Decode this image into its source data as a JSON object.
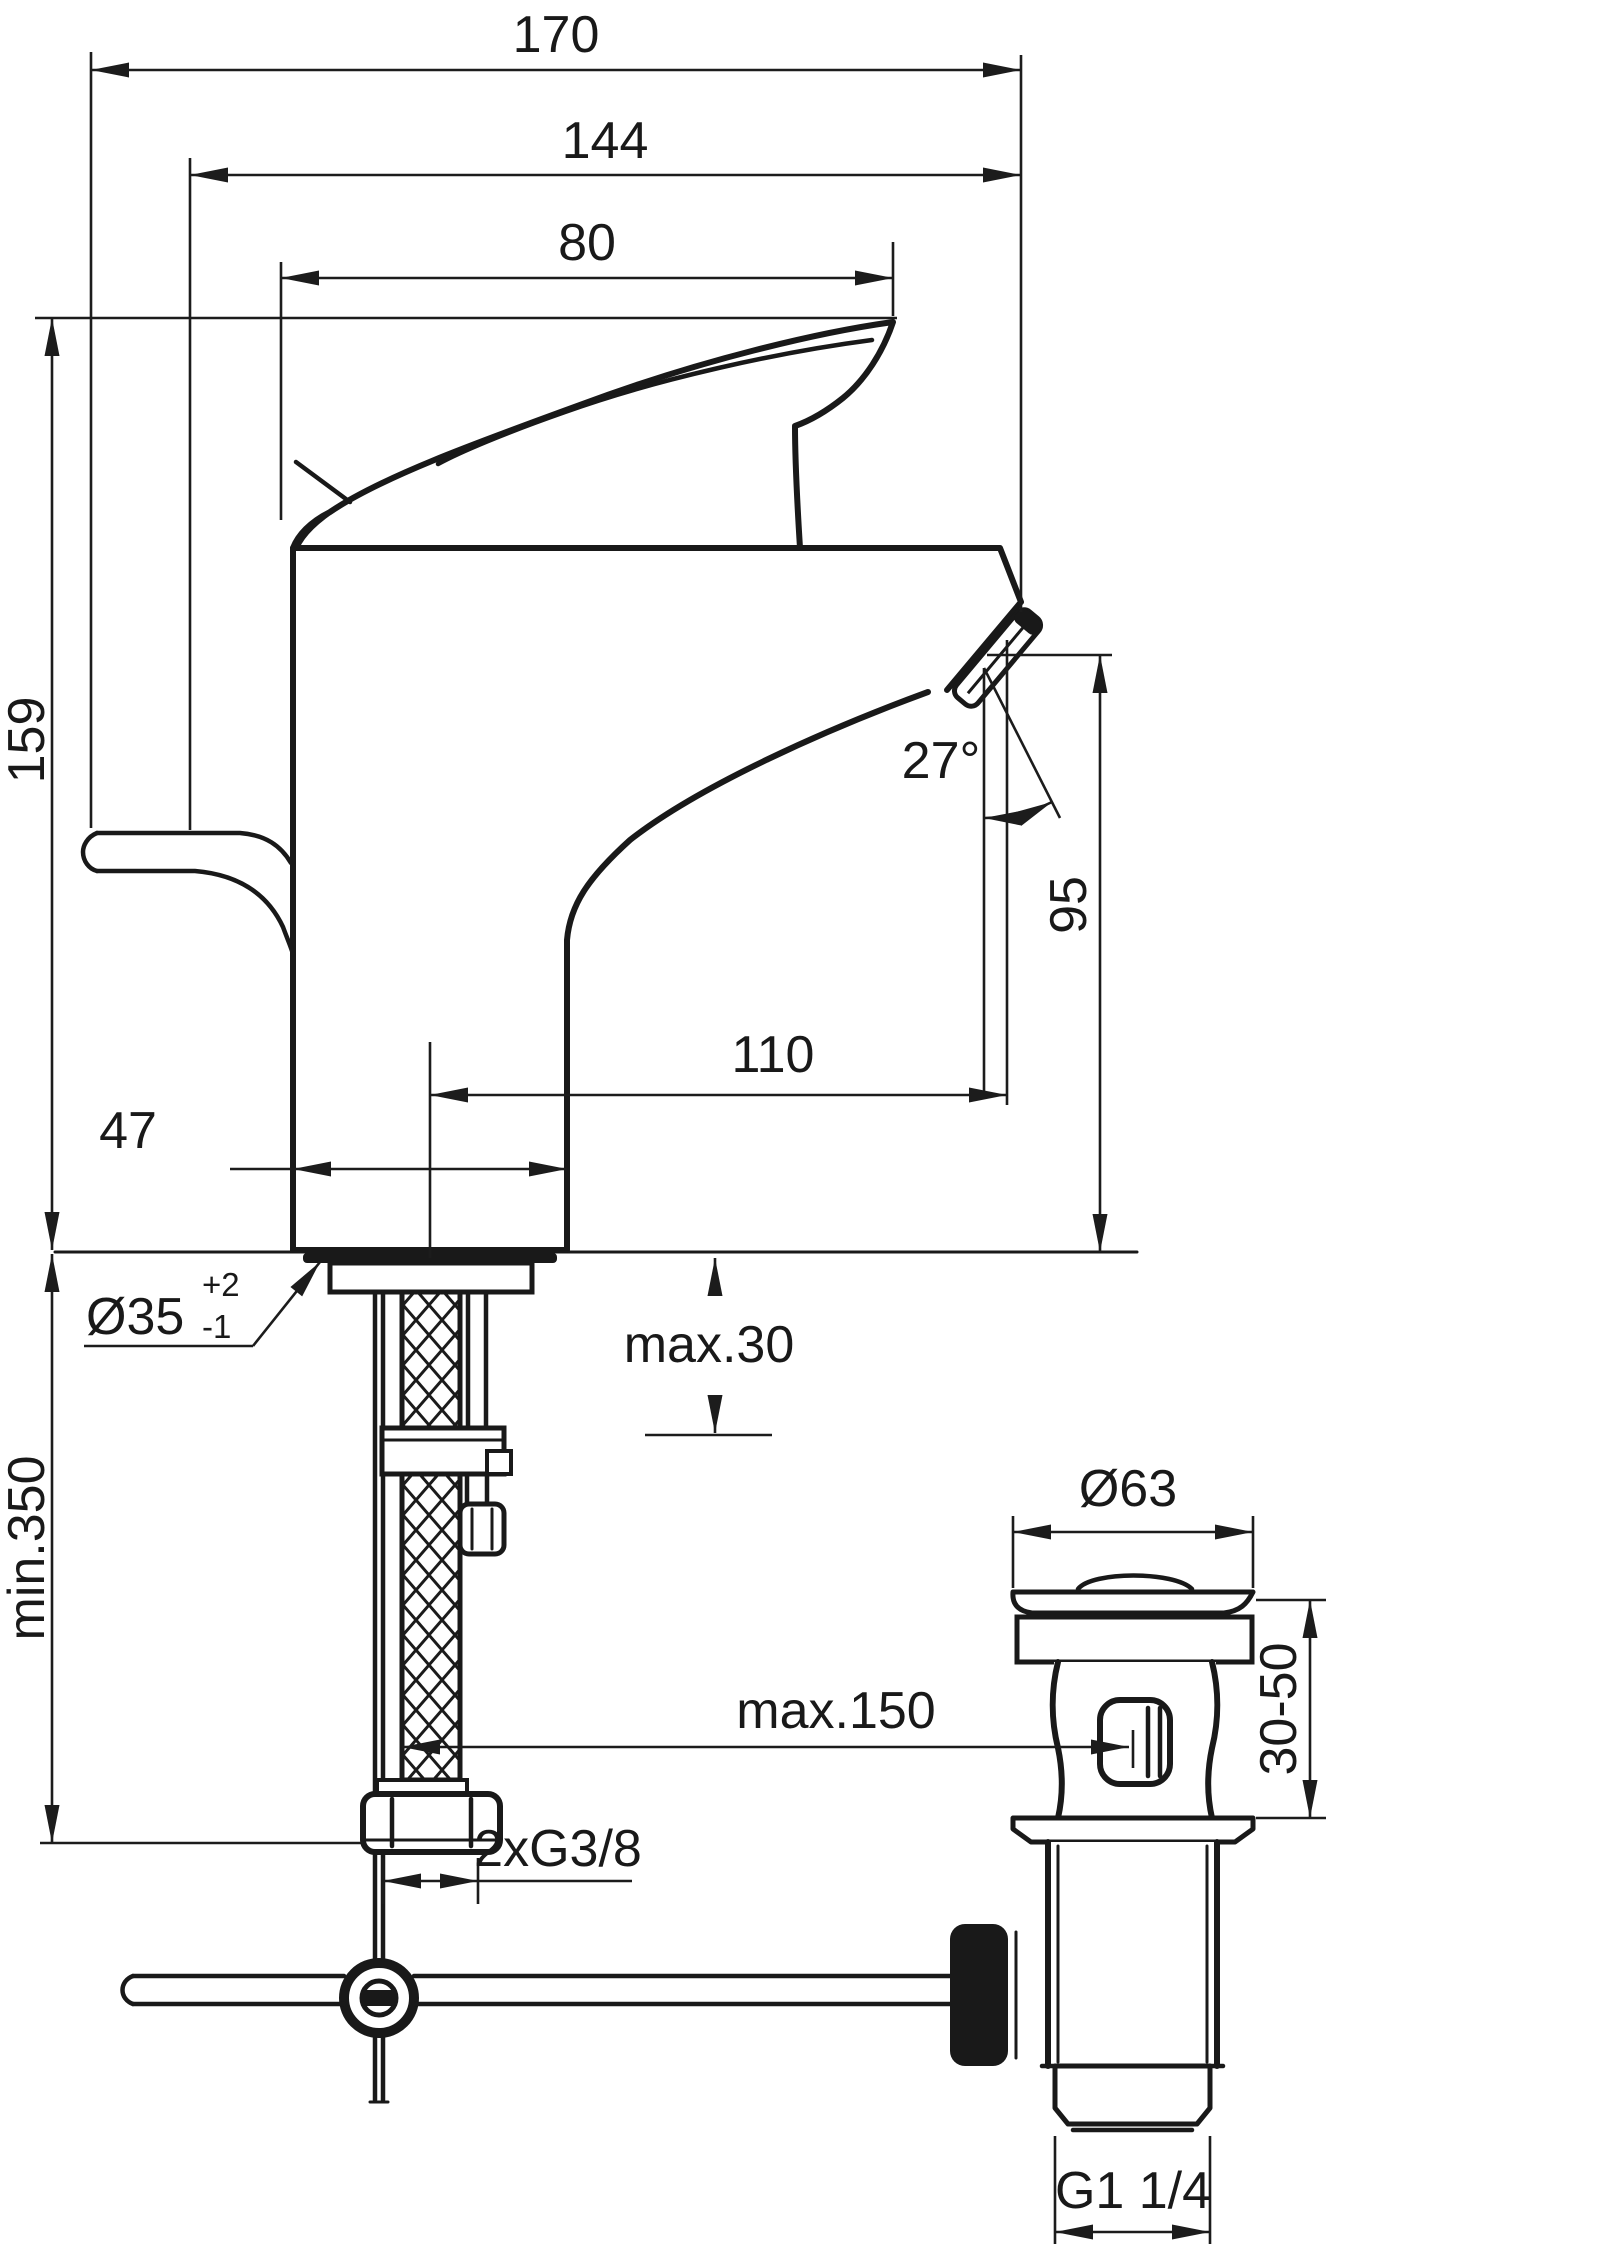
{
  "drawing": {
    "title": "single-lever basin mixer installation dimension drawing",
    "dims": {
      "overall_depth": "170",
      "spout_depth": "144",
      "handle_length": "80",
      "total_height": "159",
      "spray_angle": "27°",
      "spout_height": "95",
      "spout_reach": "110",
      "body_width": "47",
      "hole_diameter": "Ø35",
      "hole_tol_plus": "+2",
      "hole_tol_minus": "-1",
      "deck_thickness": "max.30",
      "hose_clearance": "min.350",
      "rod_reach": "max.150",
      "hose_thread": "2xG3/8",
      "waste_cap_diameter": "Ø63",
      "waste_deck_range": "30-50",
      "waste_thread": "G1 1/4"
    }
  }
}
